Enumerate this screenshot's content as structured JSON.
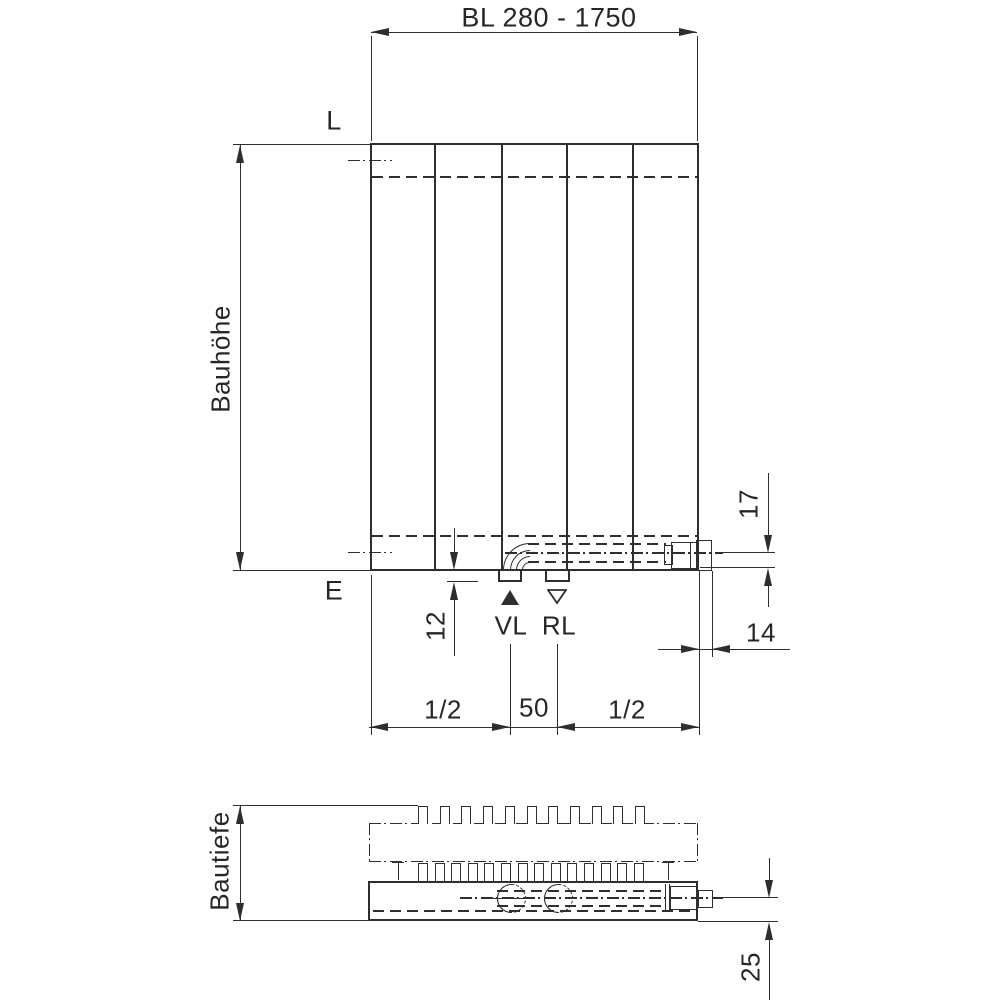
{
  "front_view": {
    "bl_dimension": "BL 280 - 1750",
    "height_label": "Bauhöhe",
    "top_edge_label": "L",
    "bottom_edge_label": "E",
    "stub_depth": "12",
    "supply_label": "VL",
    "return_label": "RL",
    "pipe_height": "17",
    "side_offset": "14",
    "left_half": "1/2",
    "center_spacing": "50",
    "right_half": "1/2"
  },
  "top_view": {
    "depth_label": "Bautiefe",
    "pipe_depth": "25"
  },
  "colors": {
    "line": "#2e2e2e",
    "background": "#ffffff"
  },
  "geometry": {
    "front_panels": 5,
    "top_fin_count": 11,
    "bottom_fin_count": 14
  }
}
